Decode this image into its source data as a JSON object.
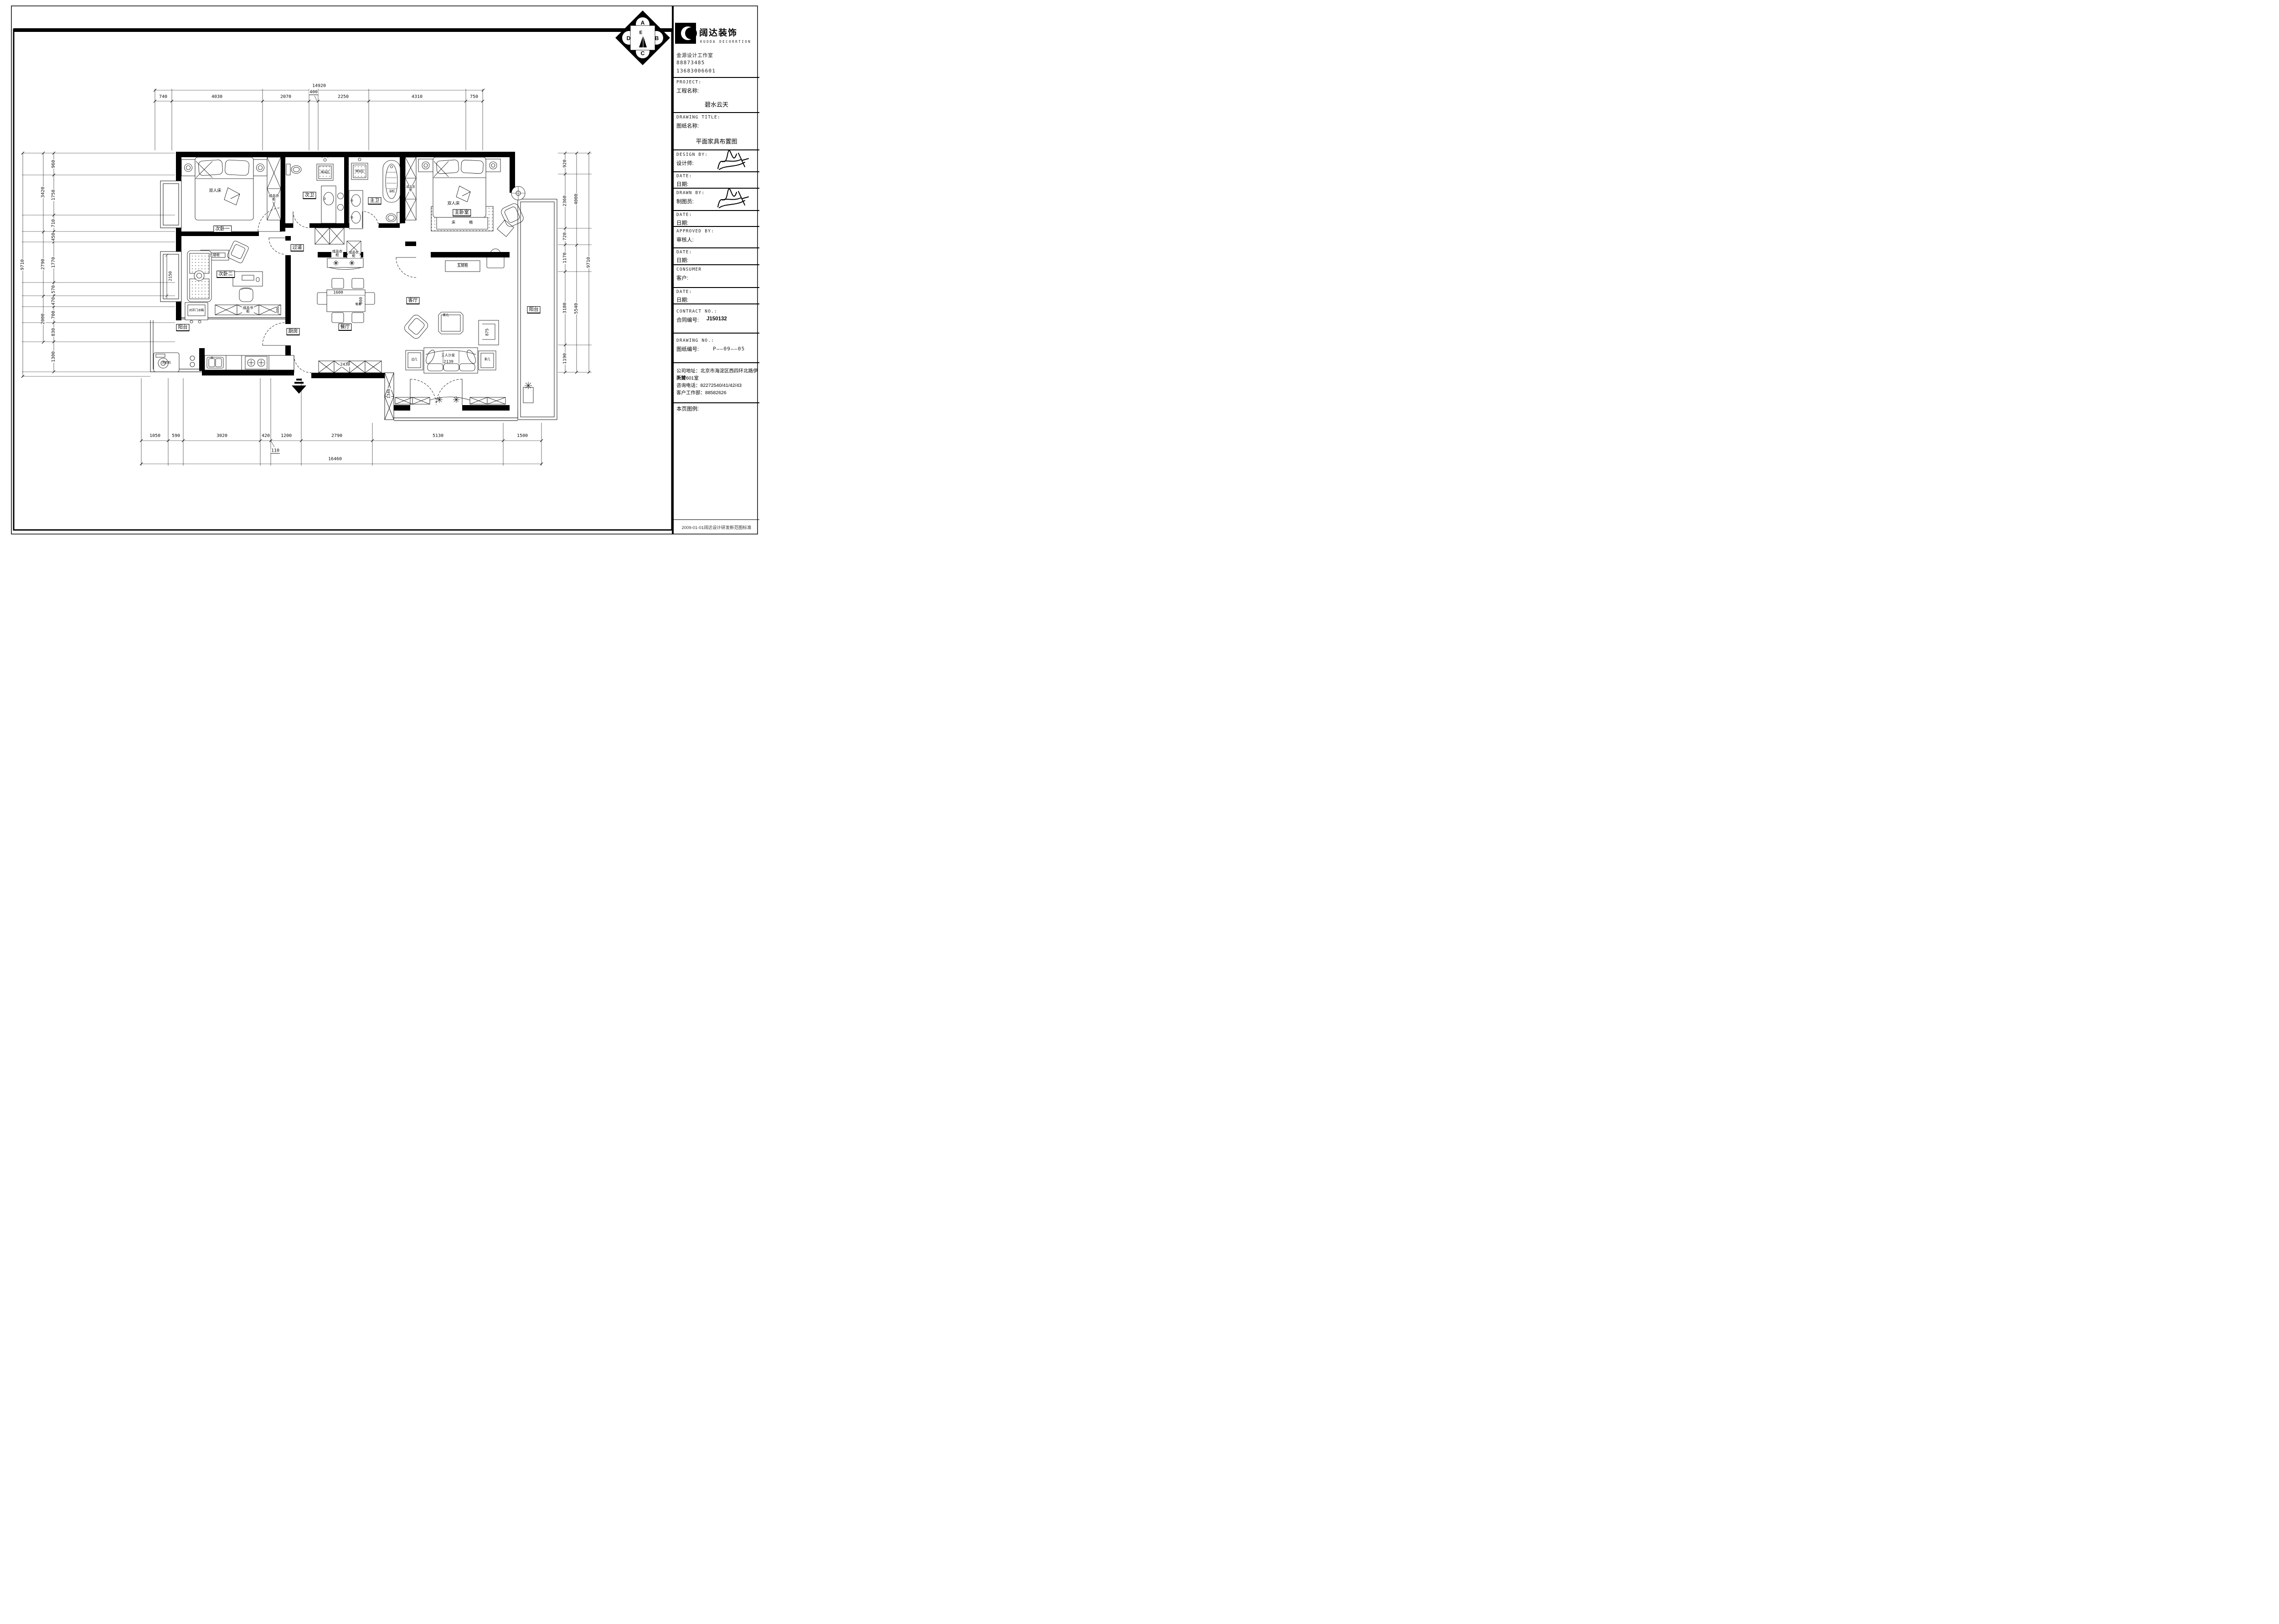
{
  "sheet": {
    "footer_note": "2009-01-01阔达设计研发新范图标准"
  },
  "title_block": {
    "company_cn": "阔达装饰",
    "company_en": "KUODA DECORRTION",
    "studio": "金源设计工作室",
    "phone_1": "88873485",
    "phone_2": "13683006601",
    "project_en": "PROJECT:",
    "project_cn": "工程名称:",
    "project_value": "碧水云天",
    "drawing_title_en": "DRAWING TITLE:",
    "drawing_title_cn": "图纸名称:",
    "drawing_title_value": "平面家具布置图",
    "design_by_en": "DESIGN BY:",
    "design_by_cn": "设计师:",
    "drawn_by_en": "DRAWN BY:",
    "drawn_by_cn": "制图员:",
    "approved_by_en": "APPROVED BY:",
    "approved_by_cn": "审核人:",
    "date_en": "DATE:",
    "date_cn": "日期:",
    "consumer_en": "CONSUMER",
    "consumer_cn": "客户:",
    "contract_en": "CONTRACT NO.:",
    "contract_cn": "合同编号:",
    "contract_value": "J150132",
    "drawing_no_en": "DRAWING NO.:",
    "drawing_no_cn": "图纸编号:",
    "drawing_no_value": "P——09——05",
    "address_1": "公司地址：北京市海淀区西四环北路伊斯特",
    "address_2": "大厦601室",
    "address_3": "咨询电话：82272540/41/42/43",
    "address_4": "客户工作部：88582626",
    "legend_label": "本页图例:"
  },
  "compass": {
    "a": "A",
    "b": "B",
    "c": "C",
    "d": "D",
    "e": "E"
  },
  "rooms": {
    "bedroom1": "次卧一",
    "bedroom2": "次卧二",
    "master_bedroom": "主卧室",
    "bath_second": "次卫",
    "bath_master": "主卫",
    "hallway": "过道",
    "dining": "餐厅",
    "living": "客厅",
    "kitchen": "厨房",
    "balcony_left": "阳台",
    "balcony_right": "阳台"
  },
  "labels": {
    "double_bed": "双人床",
    "wardrobe": "成品衣柜",
    "bookcase": "成品书柜",
    "chest": "五屉柜",
    "bed_bench": "床榻",
    "shower": "淋浴区",
    "bathtub": "浴缸",
    "washer": "洗衣机",
    "fridge": "对开门冰箱",
    "dining_table": "餐桌",
    "coffee_table": "茶几",
    "side_table": "边几",
    "sofa": "三人沙发"
  },
  "dims": {
    "top_total": "14920",
    "top": [
      "740",
      "4030",
      "2070",
      "400",
      "2250",
      "4310",
      "750"
    ],
    "bottom": [
      "1050",
      "590",
      "3020",
      "420",
      "1200",
      "2790",
      "5130",
      "1500"
    ],
    "bottom_offset": "110",
    "bottom_total": "16460",
    "left_outer": "9710",
    "left_mid": [
      "3420",
      "2790",
      "2000"
    ],
    "left_inner": [
      "960",
      "1750",
      "710",
      "450",
      "1770",
      "570",
      "470",
      "700",
      "830",
      "1300"
    ],
    "right_outer": "9710",
    "right_mid": [
      "4000",
      "5540"
    ],
    "right_inner": [
      "920",
      "2360",
      "720",
      "1170",
      "3180",
      "1190"
    ],
    "inner": {
      "dining_w": "1600",
      "dining_d": "800",
      "sofa_w": "2139",
      "armchair": "875",
      "cabinet_row": "2430",
      "hall_column": "1340",
      "bedroom2_window": "2150",
      "bookcase": "400"
    }
  }
}
